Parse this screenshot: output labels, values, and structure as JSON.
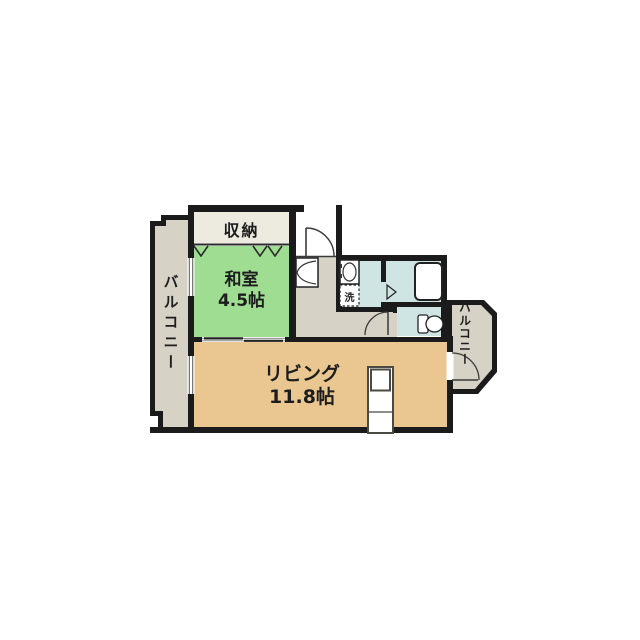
{
  "floorplan": {
    "rooms": {
      "balcony_left": {
        "label": "バルコニー"
      },
      "storage": {
        "label": "収納"
      },
      "japanese_room": {
        "label": "和室",
        "size": "4.5帖"
      },
      "living": {
        "label": "リビング",
        "size": "11.8帖"
      },
      "laundry": {
        "label": "洗"
      },
      "balcony_right": {
        "label": "バルコニー"
      }
    },
    "fixtures": [
      "entrance-door-swing",
      "entry-closet-bifold-doors",
      "closet-fold-marks",
      "washbasin",
      "washing-machine-space",
      "bathtub",
      "bath-door-mark",
      "toilet",
      "toilet-door-swing",
      "kitchen-counter",
      "balcony-door-swing",
      "sliding-door-track",
      "windows"
    ],
    "colors": {
      "wall": "#1b1b1b",
      "japanese_room_fill": "#9edd92",
      "living_fill": "#eac690",
      "balcony_fill": "#d6d2c6",
      "hallway_fill": "#d6d2c6",
      "wet_area_fill": "#cfe5e3",
      "storage_fill": "#edebe0",
      "fixture_fill": "#ffffff",
      "canvas": "#ffffff"
    }
  }
}
